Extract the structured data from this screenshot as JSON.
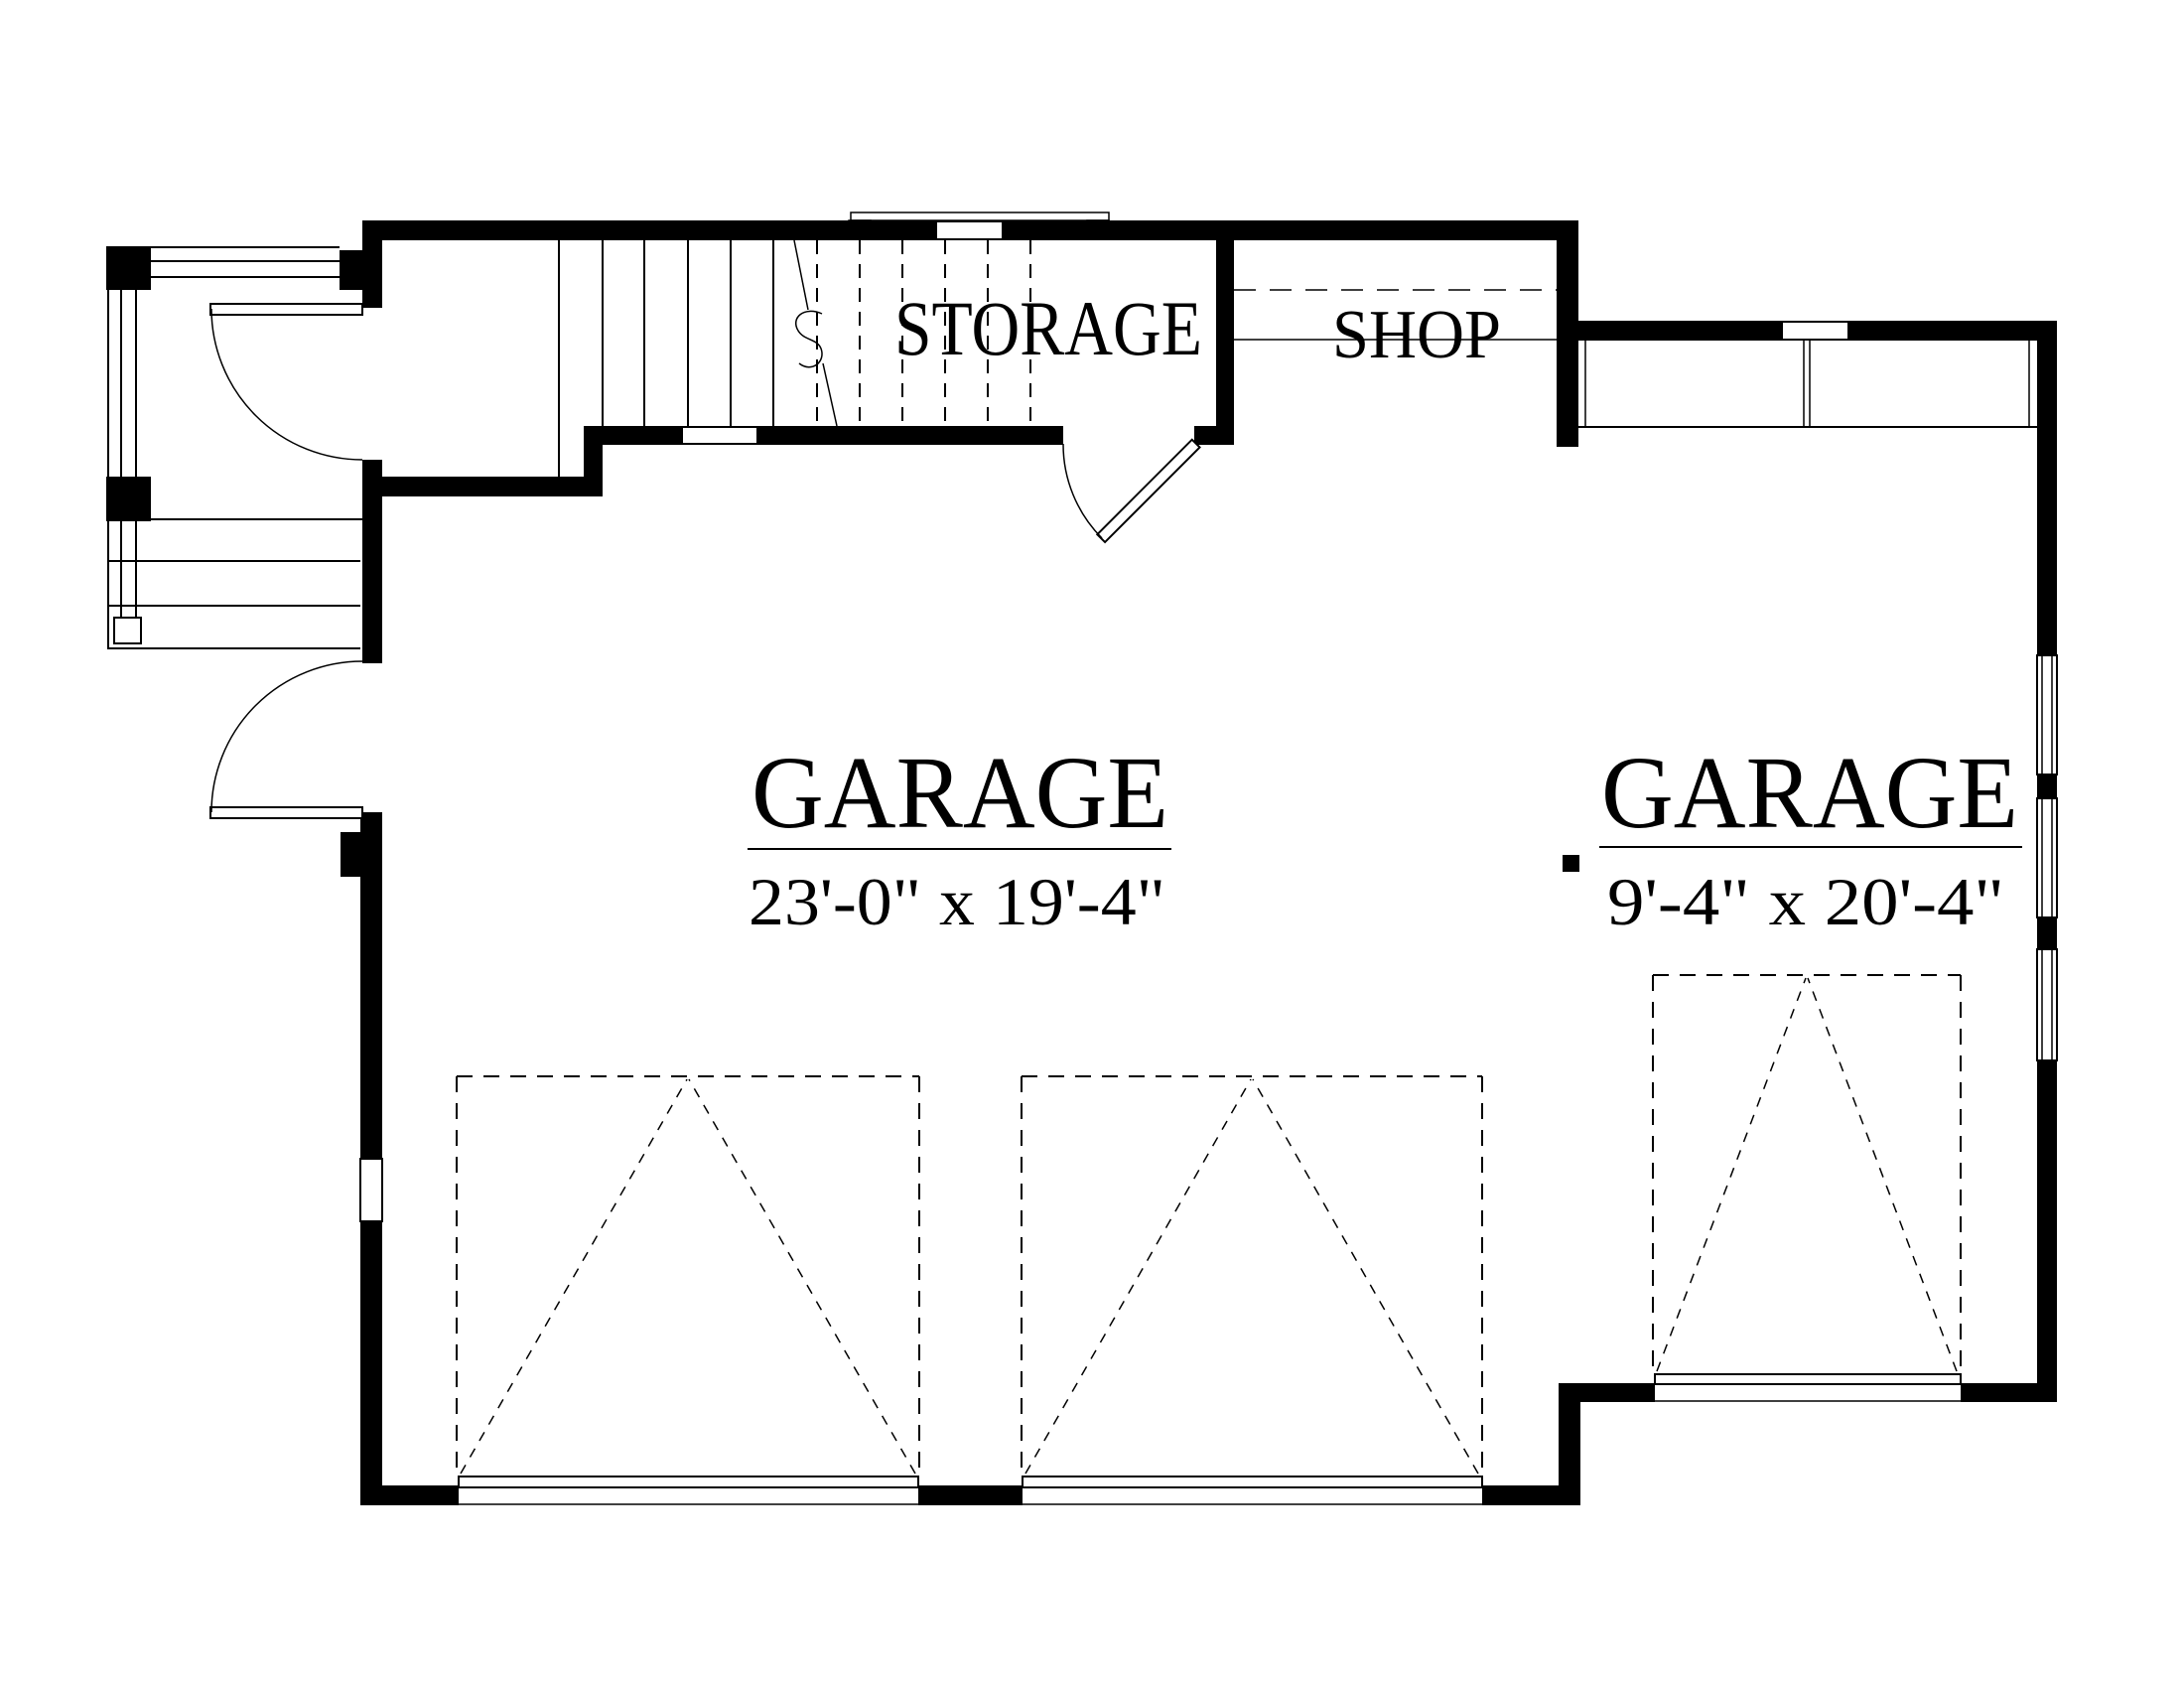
{
  "document": {
    "type": "architectural floor plan"
  },
  "rooms": {
    "storage": {
      "label": "STORAGE"
    },
    "shop": {
      "label": "SHOP"
    },
    "garage_main": {
      "label": "GARAGE",
      "dimensions": "23'-0\" x 19'-4\""
    },
    "garage_bay": {
      "label": "GARAGE",
      "dimensions": "9'-4\" x 20'-4\""
    }
  },
  "colors": {
    "wall": "#000000",
    "background": "#ffffff",
    "line": "#000000"
  }
}
